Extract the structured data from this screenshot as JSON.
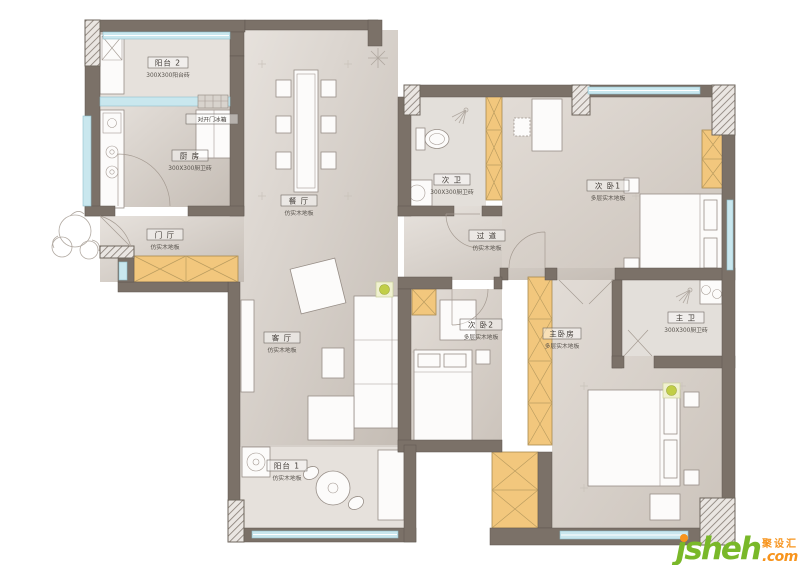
{
  "colors": {
    "wall": "#7b7168",
    "window": "#c9e7ee",
    "wardrobe": "#f2c77d",
    "floor_light": "#e6e1dc",
    "floor_mid": "#cfc7c0",
    "logo_green": "#79b829",
    "logo_orange": "#f7941d"
  },
  "rooms": [
    {
      "id": "balcony2",
      "name": "阳台 2",
      "note": "300X300阳台砖"
    },
    {
      "id": "kitchen",
      "name": "厨 房",
      "note": "300X300厨卫砖"
    },
    {
      "id": "dining",
      "name": "餐 厅",
      "note": "仿实木地板"
    },
    {
      "id": "hall",
      "name": "门 厅",
      "note": "仿实木地板"
    },
    {
      "id": "corridor",
      "name": "过 道",
      "note": "仿实木地板"
    },
    {
      "id": "bath2",
      "name": "次 卫",
      "note": "300X300厨卫砖"
    },
    {
      "id": "bedroom1",
      "name": "次 卧1",
      "note": "多层实木地板"
    },
    {
      "id": "bedroom2",
      "name": "次 卧2",
      "note": "多层实木地板"
    },
    {
      "id": "master",
      "name": "主卧房",
      "note": "多层实木地板"
    },
    {
      "id": "bath1",
      "name": "主 卫",
      "note": "300X300厨卫砖"
    },
    {
      "id": "living",
      "name": "客 厅",
      "note": "仿实木地板"
    },
    {
      "id": "balcony1",
      "name": "阳台 1",
      "note": "仿实木地板"
    }
  ],
  "annotations": {
    "fridge": "对开门冰箱"
  },
  "logo": {
    "main": "jsheh",
    "tld": ".com",
    "cn": "聚设汇"
  }
}
